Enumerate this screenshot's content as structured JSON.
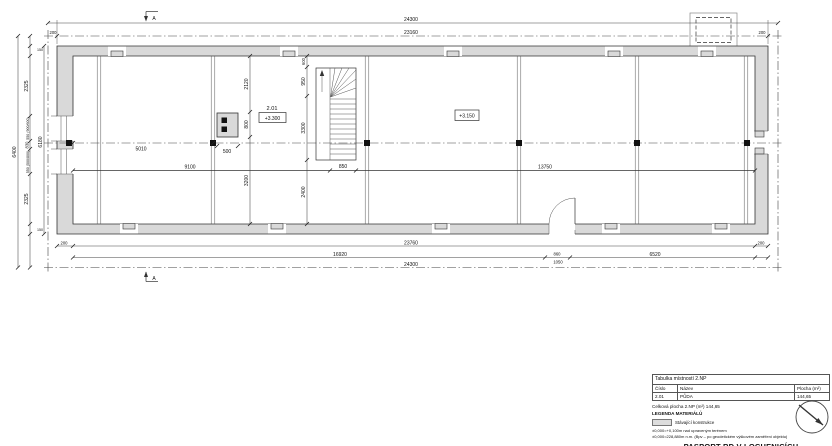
{
  "plan": {
    "section_label": "A",
    "labels": {
      "room_no": "2.01",
      "room_lvl": "+3.300",
      "open_lvl": "+3.150"
    },
    "dims": {
      "top_total": "24300",
      "top_inner": "23160",
      "top_off_l": "200",
      "top_off_r": "200",
      "bot_off_l": "200",
      "bot_span": "23760",
      "bot_off_r": "200",
      "bot_inner": "16920",
      "bot_d1": "860",
      "bot_d2": "1050",
      "bot_right": "6520",
      "bot_total": "24300",
      "left_total": "6400",
      "left_inner": "6180",
      "left_end_top": "150",
      "l1": "2325",
      "l2": "550 (900/600)",
      "l3": "830",
      "l4": "550 (500/800)",
      "l5": "2325",
      "left_end_bot": "150",
      "m1": "2120",
      "m2": "800",
      "m3": "3200",
      "s1": "600",
      "s2": "950",
      "s3": "3300",
      "s4": "2400",
      "c_left": "5010",
      "chimney_w": "500",
      "beam_l": "9100",
      "beam_r": "13750",
      "stair_w": "850"
    }
  },
  "titleblock": {
    "table_title": "Tabulka místností  2.NP",
    "col_cislo": "Číslo",
    "col_nazev": "Název",
    "col_plocha": "Plocha (m²)",
    "row_no": "2.01",
    "row_name": "PŮDA",
    "row_area": "144,65",
    "total_line": "Celková plocha 2.NP (m²)   144,65",
    "legend_title": "LEGENDA MATERIÁLŮ",
    "legend_item": "Stávající konstrukce",
    "note1": "±0,000=+0,100m nad upraveným terénem",
    "note2": "±0,000=228,880m n.m. (Bpv – po geodetickém výškovém zaměření objektu)",
    "title": "PASPORT RD V LOCHENICÍCH"
  }
}
